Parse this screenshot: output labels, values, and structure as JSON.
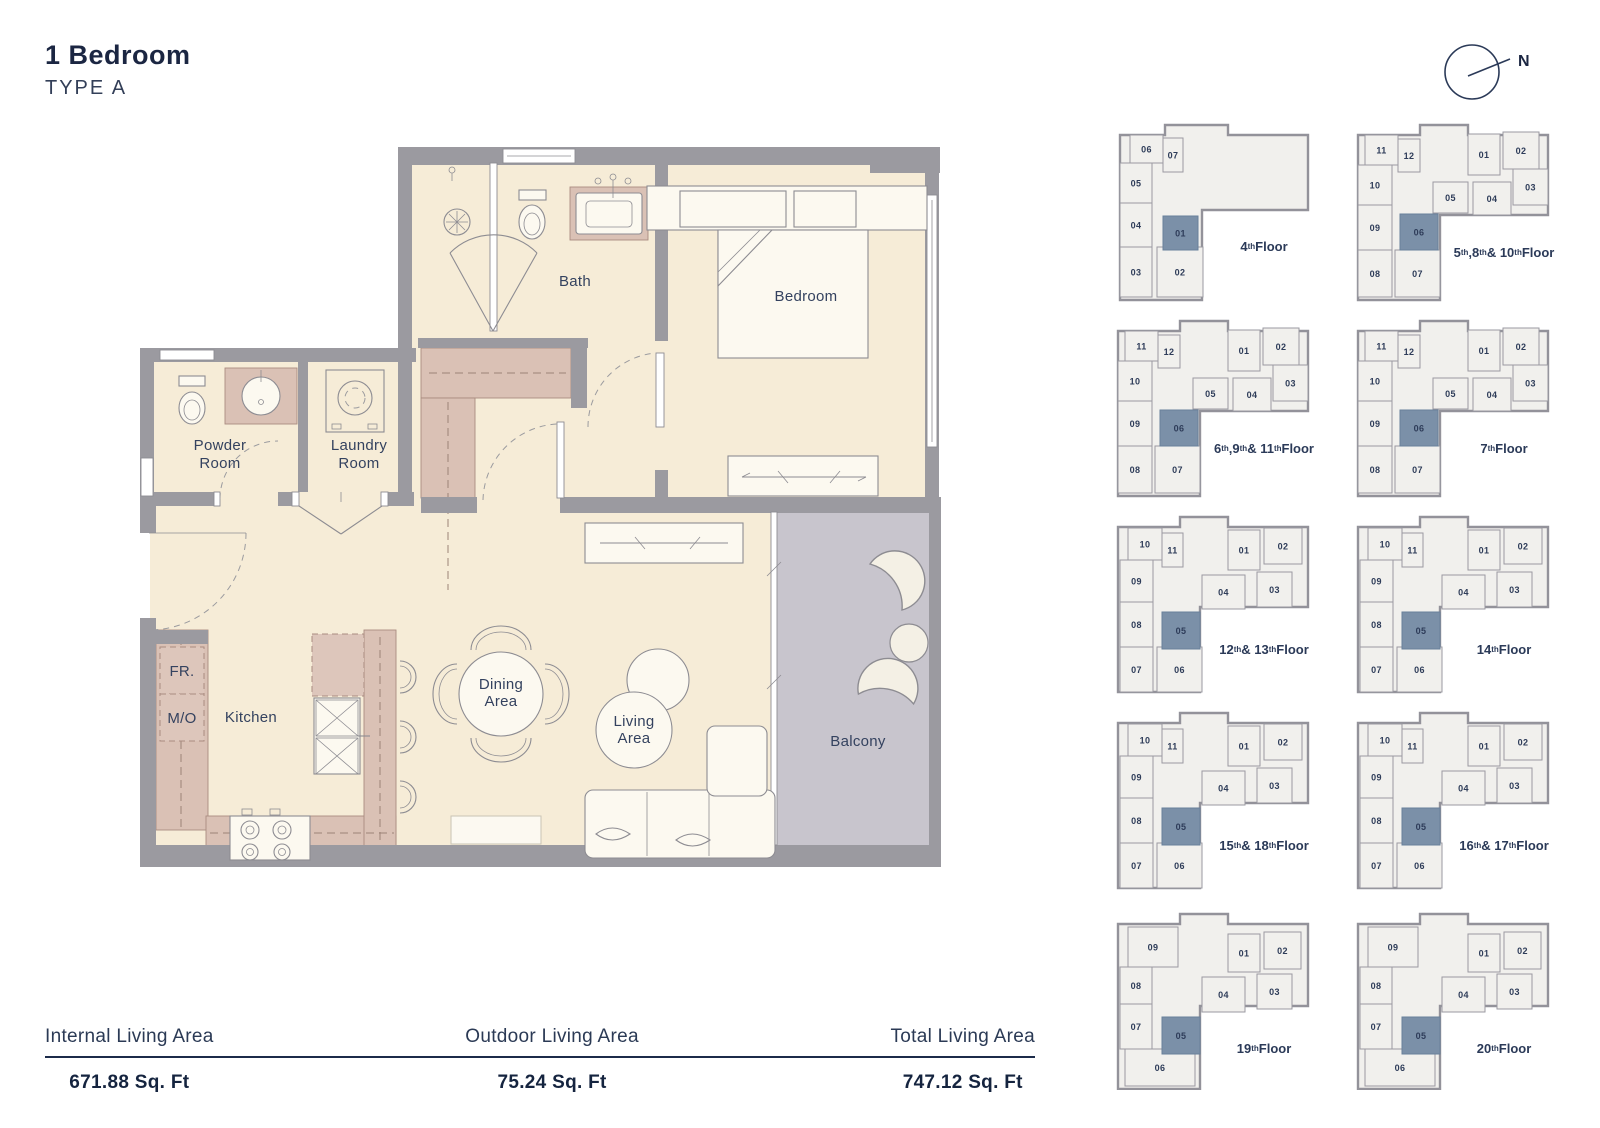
{
  "page": {
    "title": "1 Bedroom",
    "subtitle": "TYPE A"
  },
  "compass": {
    "label": "N"
  },
  "colors": {
    "floor": "#f6ecd7",
    "wall": "#9b9aa0",
    "mauve": "#dac1b5",
    "highlight": "#7b90a8",
    "navy": "#2b3a58",
    "balcony": "#c8c5cd",
    "keyplan_fill": "#f1f0ed",
    "line": "#8d8c92"
  },
  "floorplan": {
    "labels": {
      "bath": "Bath",
      "bedroom": "Bedroom",
      "powder": [
        "Powder",
        "Room"
      ],
      "laundry": [
        "Laundry",
        "Room"
      ],
      "kitchen": "Kitchen",
      "fr": "FR.",
      "mo": "M/O",
      "dining": [
        "Dining",
        "Area"
      ],
      "living": [
        "Living",
        "Area"
      ],
      "balcony": "Balcony"
    }
  },
  "keyplans": {
    "items": [
      {
        "variant": "A",
        "floor": "4th Floor",
        "units": [
          {
            "no": "06"
          },
          {
            "no": "07"
          },
          {
            "no": "05"
          },
          {
            "no": "04"
          },
          {
            "no": "03"
          },
          {
            "no": "02"
          },
          {
            "no": "01",
            "highlight": true
          }
        ]
      },
      {
        "variant": "B",
        "floor": "5th ,8th & 10th Floor",
        "units": [
          {
            "no": "11"
          },
          {
            "no": "12"
          },
          {
            "no": "10"
          },
          {
            "no": "09"
          },
          {
            "no": "08"
          },
          {
            "no": "07"
          },
          {
            "no": "06",
            "highlight": true
          },
          {
            "no": "05"
          },
          {
            "no": "04"
          },
          {
            "no": "01"
          },
          {
            "no": "02"
          },
          {
            "no": "03"
          }
        ]
      },
      {
        "variant": "B",
        "floor": "6th ,9th & 11th Floor",
        "units": [
          {
            "no": "11"
          },
          {
            "no": "12"
          },
          {
            "no": "10"
          },
          {
            "no": "09"
          },
          {
            "no": "08"
          },
          {
            "no": "07"
          },
          {
            "no": "06",
            "highlight": true
          },
          {
            "no": "05"
          },
          {
            "no": "04"
          },
          {
            "no": "01"
          },
          {
            "no": "02"
          },
          {
            "no": "03"
          }
        ]
      },
      {
        "variant": "B",
        "floor": "7th Floor",
        "units": [
          {
            "no": "11"
          },
          {
            "no": "12"
          },
          {
            "no": "10"
          },
          {
            "no": "09"
          },
          {
            "no": "08"
          },
          {
            "no": "07"
          },
          {
            "no": "06",
            "highlight": true
          },
          {
            "no": "05"
          },
          {
            "no": "04"
          },
          {
            "no": "01"
          },
          {
            "no": "02"
          },
          {
            "no": "03"
          }
        ]
      },
      {
        "variant": "C",
        "floor": "12th & 13th Floor",
        "units": [
          {
            "no": "10"
          },
          {
            "no": "11"
          },
          {
            "no": "09"
          },
          {
            "no": "08"
          },
          {
            "no": "07"
          },
          {
            "no": "06"
          },
          {
            "no": "05",
            "highlight": true
          },
          {
            "no": "04"
          },
          {
            "no": "03"
          },
          {
            "no": "01"
          },
          {
            "no": "02"
          }
        ]
      },
      {
        "variant": "C",
        "floor": "14th Floor",
        "units": [
          {
            "no": "10"
          },
          {
            "no": "11"
          },
          {
            "no": "09"
          },
          {
            "no": "08"
          },
          {
            "no": "07"
          },
          {
            "no": "06"
          },
          {
            "no": "05",
            "highlight": true
          },
          {
            "no": "04"
          },
          {
            "no": "03"
          },
          {
            "no": "01"
          },
          {
            "no": "02"
          }
        ]
      },
      {
        "variant": "C",
        "floor": "15th & 18th Floor",
        "units": [
          {
            "no": "10"
          },
          {
            "no": "11"
          },
          {
            "no": "09"
          },
          {
            "no": "08"
          },
          {
            "no": "07"
          },
          {
            "no": "06"
          },
          {
            "no": "05",
            "highlight": true
          },
          {
            "no": "04"
          },
          {
            "no": "03"
          },
          {
            "no": "01"
          },
          {
            "no": "02"
          }
        ]
      },
      {
        "variant": "C",
        "floor": "16th & 17th Floor",
        "units": [
          {
            "no": "10"
          },
          {
            "no": "11"
          },
          {
            "no": "09"
          },
          {
            "no": "08"
          },
          {
            "no": "07"
          },
          {
            "no": "06"
          },
          {
            "no": "05",
            "highlight": true
          },
          {
            "no": "04"
          },
          {
            "no": "03"
          },
          {
            "no": "01"
          },
          {
            "no": "02"
          }
        ]
      },
      {
        "variant": "D",
        "floor": "19th Floor",
        "units": [
          {
            "no": "09"
          },
          {
            "no": "08"
          },
          {
            "no": "07"
          },
          {
            "no": "06"
          },
          {
            "no": "05",
            "highlight": true
          },
          {
            "no": "04"
          },
          {
            "no": "03"
          },
          {
            "no": "01"
          },
          {
            "no": "02"
          }
        ]
      },
      {
        "variant": "D",
        "floor": "20th Floor",
        "units": [
          {
            "no": "09"
          },
          {
            "no": "08"
          },
          {
            "no": "07"
          },
          {
            "no": "06"
          },
          {
            "no": "05",
            "highlight": true
          },
          {
            "no": "04"
          },
          {
            "no": "03"
          },
          {
            "no": "01"
          },
          {
            "no": "02"
          }
        ]
      }
    ]
  },
  "stats": {
    "columns": [
      {
        "label": "Internal Living Area",
        "value": "671.88 Sq. Ft"
      },
      {
        "label": "Outdoor Living Area",
        "value": "75.24 Sq. Ft"
      },
      {
        "label": "Total Living Area",
        "value": "747.12 Sq. Ft"
      }
    ]
  }
}
